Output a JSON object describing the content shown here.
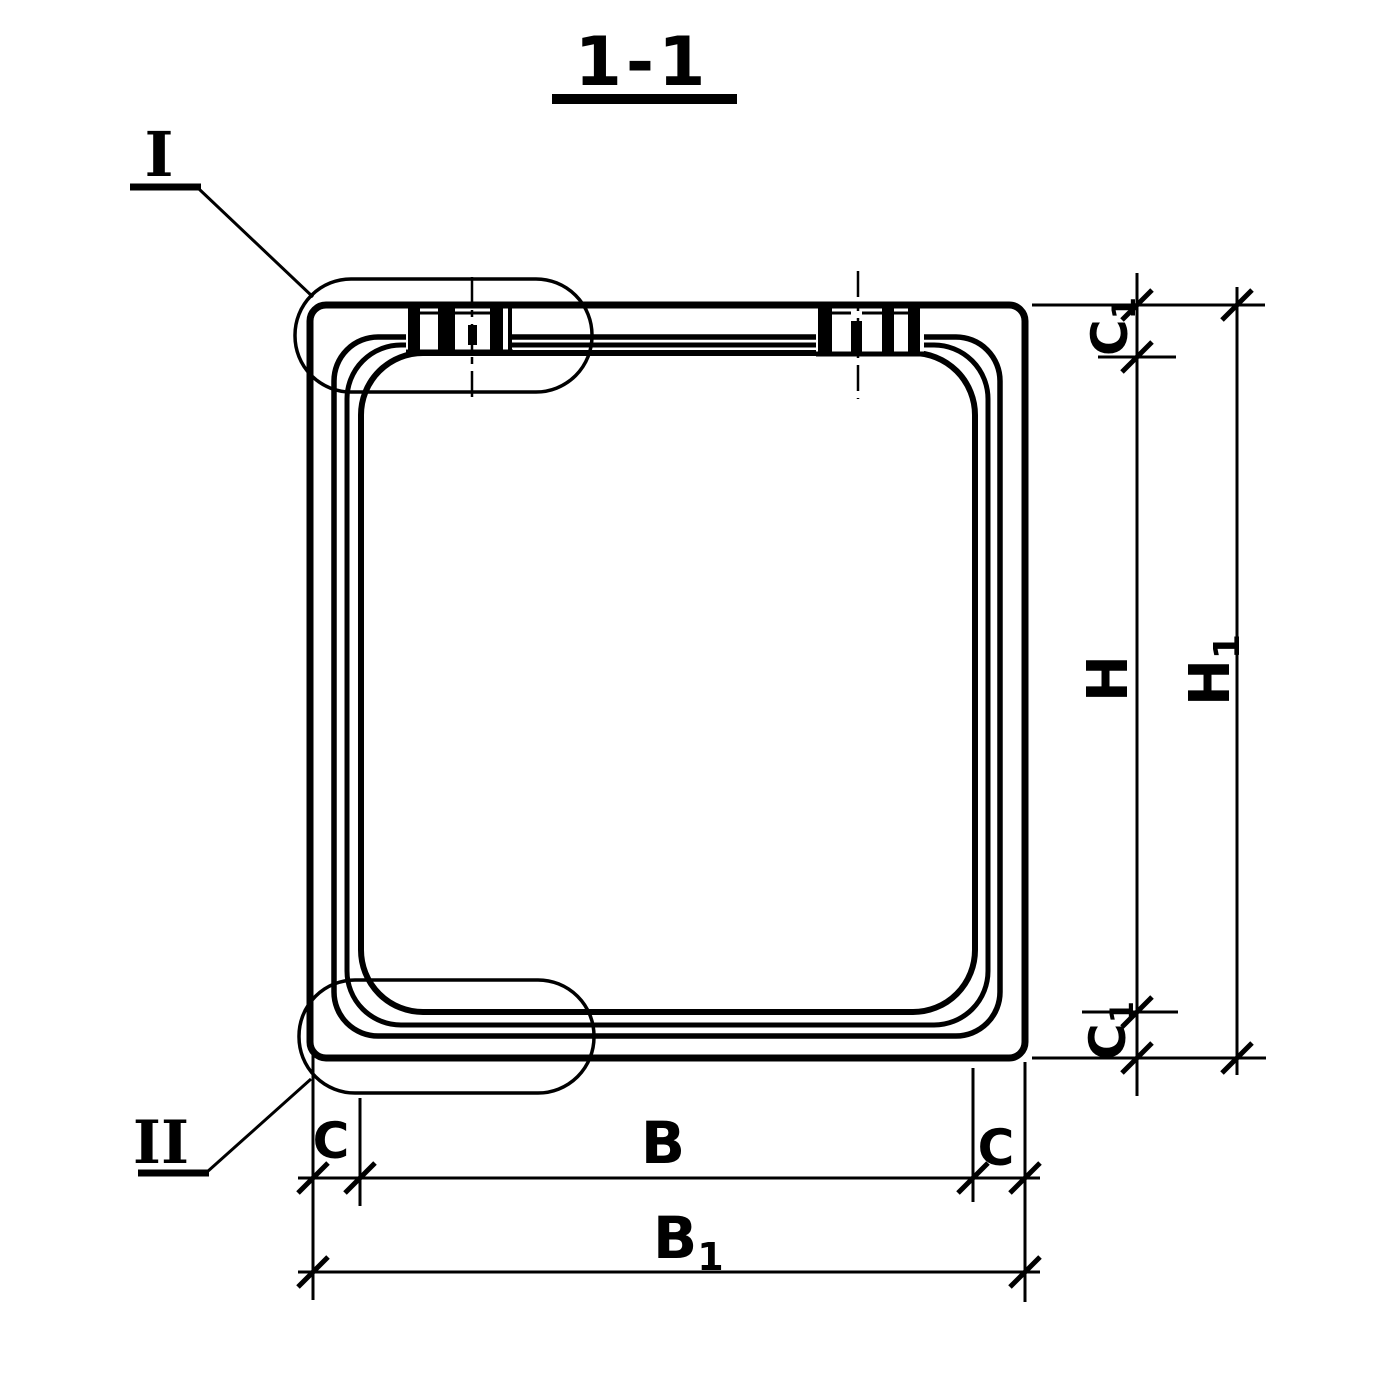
{
  "colors": {
    "ink": "#000000",
    "paper": "#ffffff"
  },
  "title": {
    "text": "1-1"
  },
  "callouts": {
    "detail_1": {
      "label": "I"
    },
    "detail_2": {
      "label": "II"
    }
  },
  "dimensions": {
    "c1_top": {
      "base": "C",
      "sub": "1"
    },
    "h": {
      "base": "H",
      "sub": ""
    },
    "h1": {
      "base": "H",
      "sub": "1"
    },
    "c1_bottom": {
      "base": "C",
      "sub": "1"
    },
    "c_left": {
      "base": "C",
      "sub": ""
    },
    "b": {
      "base": "B",
      "sub": ""
    },
    "c_right": {
      "base": "C",
      "sub": ""
    },
    "b1": {
      "base": "B",
      "sub": "1"
    }
  }
}
